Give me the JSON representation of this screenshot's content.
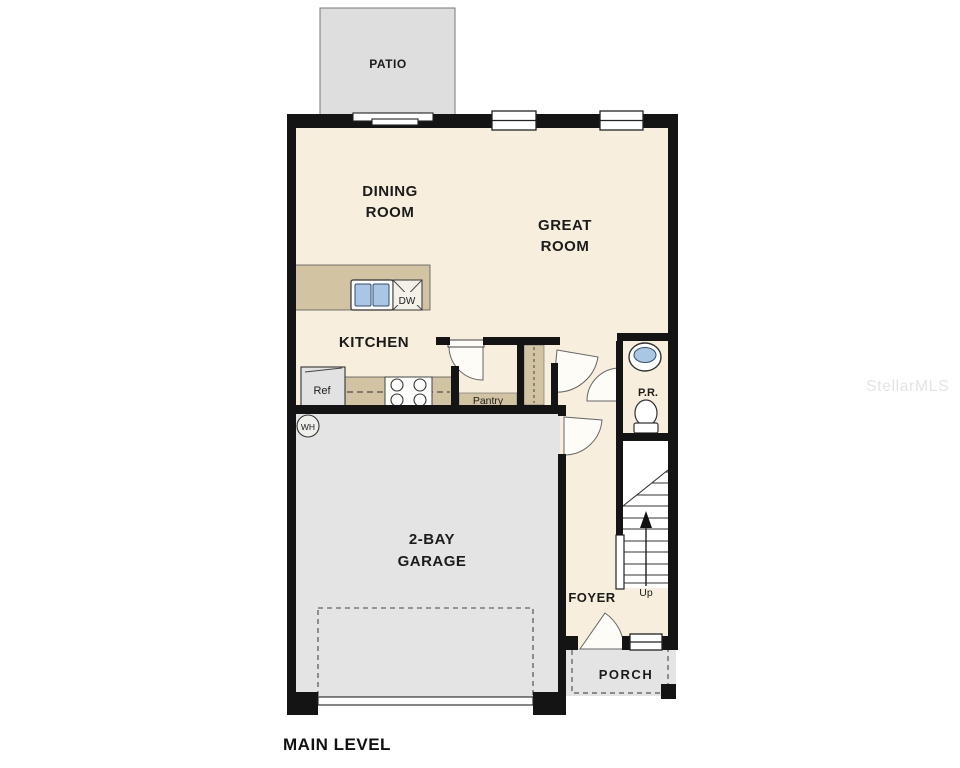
{
  "title": "MAIN LEVEL",
  "watermark": "StellarMLS",
  "colors": {
    "floor": "#f7eedd",
    "garage": "#e4e4e4",
    "patio": "#dedede",
    "porch": "#e4e4e4",
    "cabinet": "#d2c3a3",
    "wall": "#141414",
    "fixture_blue": "#a9c6e4",
    "label": "#1b1b1b",
    "watermark": "#cfcfcf"
  },
  "rooms": {
    "patio": {
      "label": "PATIO"
    },
    "dining": {
      "line1": "DINING",
      "line2": "ROOM"
    },
    "great": {
      "line1": "GREAT",
      "line2": "ROOM"
    },
    "kitchen": {
      "label": "KITCHEN"
    },
    "pantry": {
      "label": "Pantry"
    },
    "powder": {
      "label": "P.R."
    },
    "garage": {
      "line1": "2-BAY",
      "line2": "GARAGE"
    },
    "foyer": {
      "label": "FOYER"
    },
    "porch": {
      "label": "PORCH"
    }
  },
  "fixtures": {
    "refrigerator": "Ref",
    "dishwasher": "DW",
    "water_heater": "WH",
    "stairs_direction": "Up"
  }
}
